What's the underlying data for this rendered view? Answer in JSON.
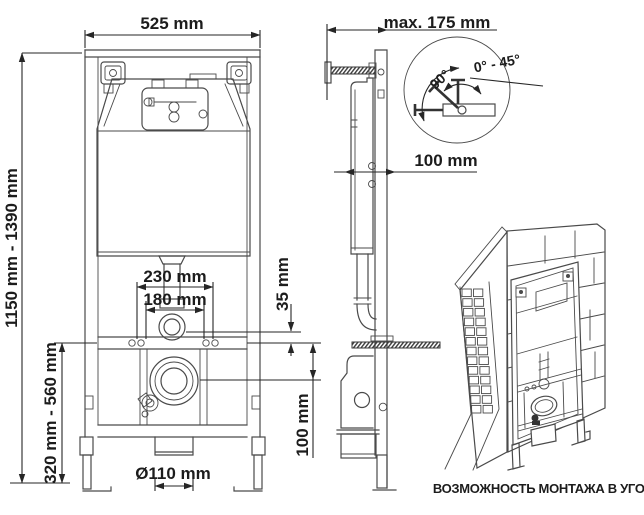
{
  "colors": {
    "background": "#ffffff",
    "line": "#4a4a4a",
    "dimension": "#262626",
    "text": "#1c1c1c"
  },
  "front_view": {
    "width": "525 mm",
    "height_range": "1150 mm - 1390 mm",
    "fixing_outer_width": "230 mm",
    "fixing_inner_width": "180 mm",
    "flush_offset": "35 mm",
    "outlet_height_range": "320 mm - 560 mm",
    "outlet_drop": "100 mm",
    "outlet_diameter": "Ø110 mm"
  },
  "side_view": {
    "max_depth": "max. 175 mm",
    "frame_depth": "100 mm"
  },
  "angle_detail": {
    "angle": "90°",
    "angle_range": "0° - 45°"
  },
  "corner_view": {
    "caption": "ВОЗМОЖНОСТЬ МОНТАЖА В УГОЛ"
  }
}
